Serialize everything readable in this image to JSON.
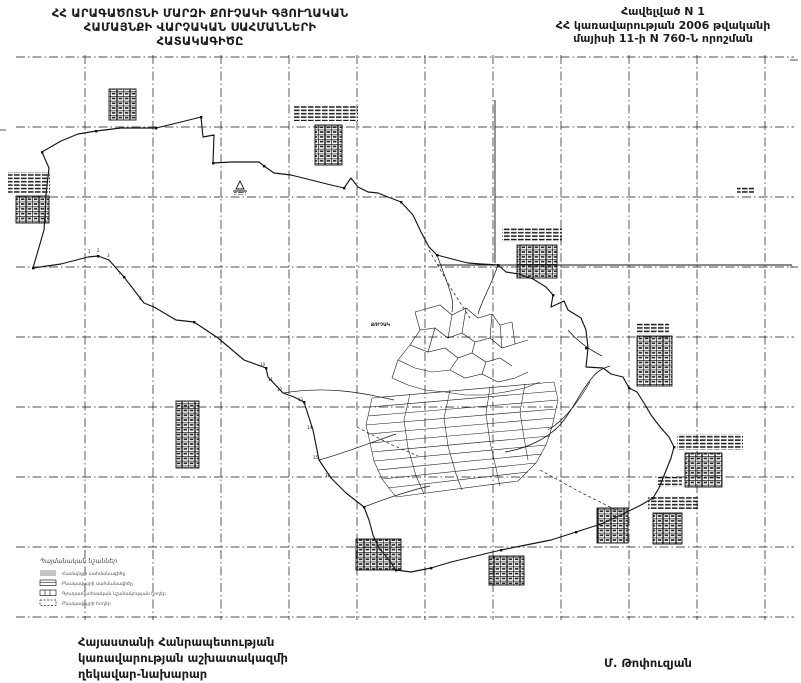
{
  "colors": {
    "ink": "#161616",
    "grid": "#4a4a4a",
    "paper": "#ffffff"
  },
  "header": {
    "title_left": {
      "lines": [
        "ՀՀ ԱՐԱԳԱԾՈՏՆԻ ՄԱՐԶԻ ՔՈՒՉԱԿԻ ԳՅՈՒՂԱԿԱՆ",
        "ՀԱՄԱՅՆՔԻ ՎԱՐՉԱԿԱՆ  ՍԱՀՄԱՆՆԵՐԻ",
        "ՀԱՏԱԿԱԳԻԾԸ"
      ]
    },
    "title_right": {
      "lines": [
        "Հավելված N 1",
        "ՀՀ կառավարության 2006 թվականի",
        "մայիսի 11-ի N 760-Ն որոշման"
      ]
    }
  },
  "map": {
    "village_label": "ՔՈՒՉԱԿ",
    "legend": {
      "title": "Պայմանական նշաններ",
      "items": [
        {
          "label": "Համայնքի սահմանագիծը"
        },
        {
          "label": "Բնակավայրի սահմանագիծը"
        },
        {
          "label": "Գյուղատնտեսական նշանակության հողեր"
        },
        {
          "label": "Բնակավայրի հողեր"
        }
      ]
    },
    "point_numbers": [
      "1",
      "2",
      "3",
      "7",
      "8",
      "10",
      "11",
      "12",
      "13",
      "14",
      "15",
      "16"
    ]
  },
  "footer": {
    "left": {
      "lines": [
        "Հայաստանի Հանրապետության",
        "կառավարության աշխատակազմի",
        "ղեկավար-նախարար"
      ]
    },
    "signature": "Մ. Թոփուզյան"
  }
}
